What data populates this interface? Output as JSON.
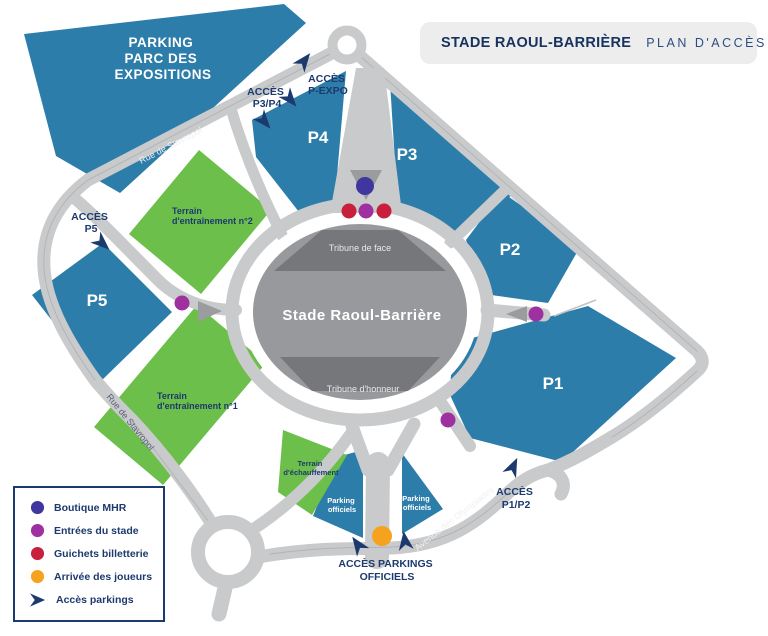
{
  "header": {
    "logo": "mhr-shield-logo",
    "title_strong": "STADE RAOUL-BARRIÈRE",
    "title_light": "PLAN D'ACCÈS"
  },
  "map": {
    "parkings": {
      "parc_expo_l1": "PARKING",
      "parc_expo_l2": "PARC DES",
      "parc_expo_l3": "EXPOSITIONS",
      "p1": "P1",
      "p2": "P2",
      "p3": "P3",
      "p4": "P4",
      "p5": "P5",
      "officiels_l1": "Parking",
      "officiels_l2": "officiels"
    },
    "fields": {
      "training2_l1": "Terrain",
      "training2_l2": "d'entraînement n°2",
      "training1_l1": "Terrain",
      "training1_l2": "d'entraînement n°1",
      "warmup_l1": "Terrain",
      "warmup_l2": "d'échauffement"
    },
    "stadium": {
      "name": "Stade Raoul-Barrière",
      "tribune_face": "Tribune de face",
      "tribune_honneur": "Tribune d'honneur"
    },
    "streets": {
      "stavropol_upper": "Rue de Stavropol",
      "stavropol_lower": "Rue de Stavropol",
      "olympiades": "Avenue des Olympiades"
    },
    "access": {
      "p3p4_l1": "ACCÈS",
      "p3p4_l2": "P3/P4",
      "pexpo_l1": "ACCÈS",
      "pexpo_l2": "P-EXPO",
      "p5_l1": "ACCÈS",
      "p5_l2": "P5",
      "p1p2_l1": "ACCÈS",
      "p1p2_l2": "P1/P2",
      "officiels_l1": "ACCÈS PARKINGS",
      "officiels_l2": "OFFICIELS"
    }
  },
  "legend": {
    "items": [
      {
        "label": "Boutique MHR",
        "marker": "dot",
        "color": "#4036a0"
      },
      {
        "label": "Entrées du stade",
        "marker": "dot",
        "color": "#9e30a0"
      },
      {
        "label": "Guichets billetterie",
        "marker": "dot",
        "color": "#c8203c"
      },
      {
        "label": "Arrivée des joueurs",
        "marker": "dot",
        "color": "#f5a21f"
      },
      {
        "label": "Accès parkings",
        "marker": "arrow",
        "color": "#1d3a6e"
      }
    ]
  },
  "palette": {
    "parking_blue": "#2d7dab",
    "field_green": "#6cbf4a",
    "road_gray": "#c9cacb",
    "stadium_gray": "#97999c",
    "stand_gray": "#75777b",
    "navy": "#1d3a6e",
    "header_bg": "#ededed"
  }
}
